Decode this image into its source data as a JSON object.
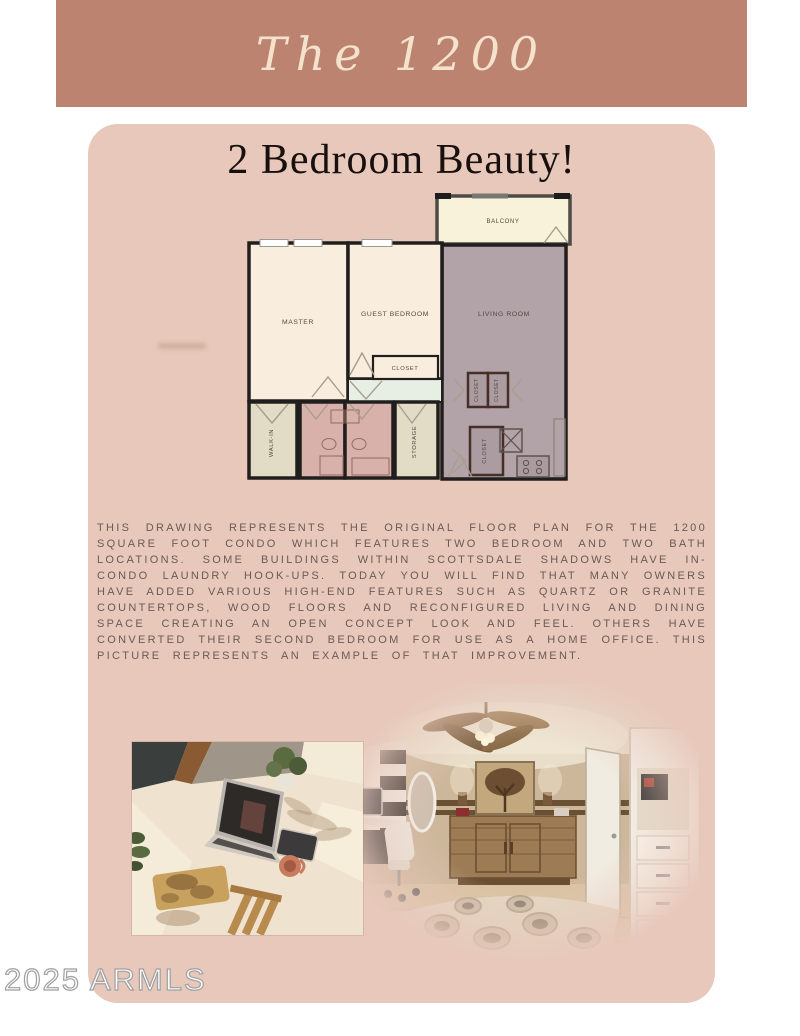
{
  "banner": {
    "title": "The 1200"
  },
  "card": {
    "heading": "2 Bedroom Beauty!"
  },
  "floorplan": {
    "labels": {
      "master": "MASTER",
      "guest_bedroom": "GUEST BEDROOM",
      "living_room": "LIVING ROOM",
      "balcony": "BALCONY",
      "closet": "CLOSET",
      "walk_in": "WALK-IN",
      "storage": "STORAGE"
    },
    "colors": {
      "wall": "#211f1d",
      "bedroom_cream": "#f9eede",
      "balcony_cream": "#f9f2da",
      "living_mauve": "#b2a3a8",
      "bath_pink": "#d8b2aa",
      "closet_beige": "#e2dbc5",
      "hallway_mint": "#e7efe5"
    }
  },
  "description": {
    "text": "THIS DRAWING REPRESENTS THE ORIGINAL FLOOR PLAN FOR THE 1200 SQUARE FOOT CONDO WHICH FEATURES TWO BEDROOM AND TWO BATH LOCATIONS. SOME BUILDINGS WITHIN SCOTTSDALE SHADOWS HAVE IN-CONDO LAUNDRY HOOK-UPS. TODAY YOU WILL FIND THAT MANY OWNERS HAVE ADDED VARIOUS HIGH-END FEATURES SUCH AS QUARTZ OR GRANITE COUNTERTOPS, WOOD FLOORS AND RECONFIGURED LIVING AND DINING SPACE CREATING AN OPEN CONCEPT LOOK AND FEEL. OTHERS HAVE CONVERTED THEIR SECOND BEDROOM FOR USE AS A HOME OFFICE. THIS PICTURE REPRESENTS AN EXAMPLE OF THAT IMPROVEMENT."
  },
  "watermark": {
    "text": "2025 ARMLS"
  },
  "theme": {
    "page_bg": "#ffffff",
    "banner_bg": "#bc8470",
    "banner_text": "#f4e2cc",
    "card_bg": "#e7c8bb",
    "heading_color": "#17100e",
    "body_text_color": "#6b5a54",
    "watermark_color": "#a0a0a0"
  }
}
